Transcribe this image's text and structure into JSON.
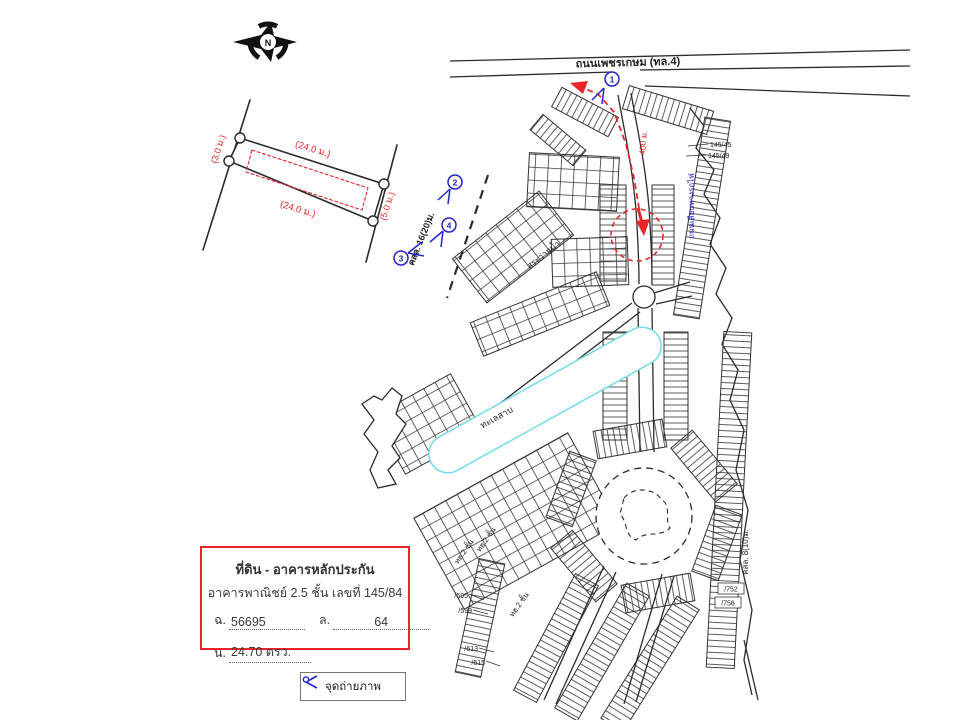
{
  "colors": {
    "red": "#e8262a",
    "blue": "#2424cc",
    "cyan": "#7adce6",
    "ink": "#2b2b2b"
  },
  "compass": {
    "letter": "N"
  },
  "sketch": {
    "top_dim": "(24.0 ม.)",
    "bottom_dim": "(24.0 ม.)",
    "left_dim": "(3.0 ม.)",
    "right_dim": "(5.0 ม.)"
  },
  "map": {
    "highway_label": "ถนนเพชรเกษม (ทล.4)",
    "road_16_label": "คสล. 16(20)ม.",
    "road_8_label": "คสล. 8(10)ม.",
    "route_distance_label": "400 ม.",
    "side_road_label": "ถนนเลียบทางรถไฟ",
    "pool_label": "สระว่ายน้ำ",
    "lake_label": "ทะเลสาบ",
    "house_row_label": "ทฮ.2 ชั้น",
    "ref_145_45": "145/45",
    "ref_145_49": "145/49",
    "lot_595": "/595",
    "lot_599": "/599",
    "lot_613": "/613",
    "lot_615": "/615",
    "lot_752": "/752",
    "lot_756": "/756",
    "camera_1": "1",
    "camera_2": "2",
    "camera_3": "3",
    "camera_4": "4"
  },
  "info_box": {
    "title": "ที่ดิน - อาคารหลักประกัน",
    "subtitle": "อาคารพาณิชย์ 2.5 ชั้น เลขที่ 145/84",
    "deed_label": "ฉ.",
    "deed_value": "56695",
    "land_label": "ล.",
    "land_value": "64",
    "area_label": "น.",
    "area_value": "24.70 ตรว."
  },
  "legend": {
    "camera_label": "จุดถ่ายภาพ"
  }
}
